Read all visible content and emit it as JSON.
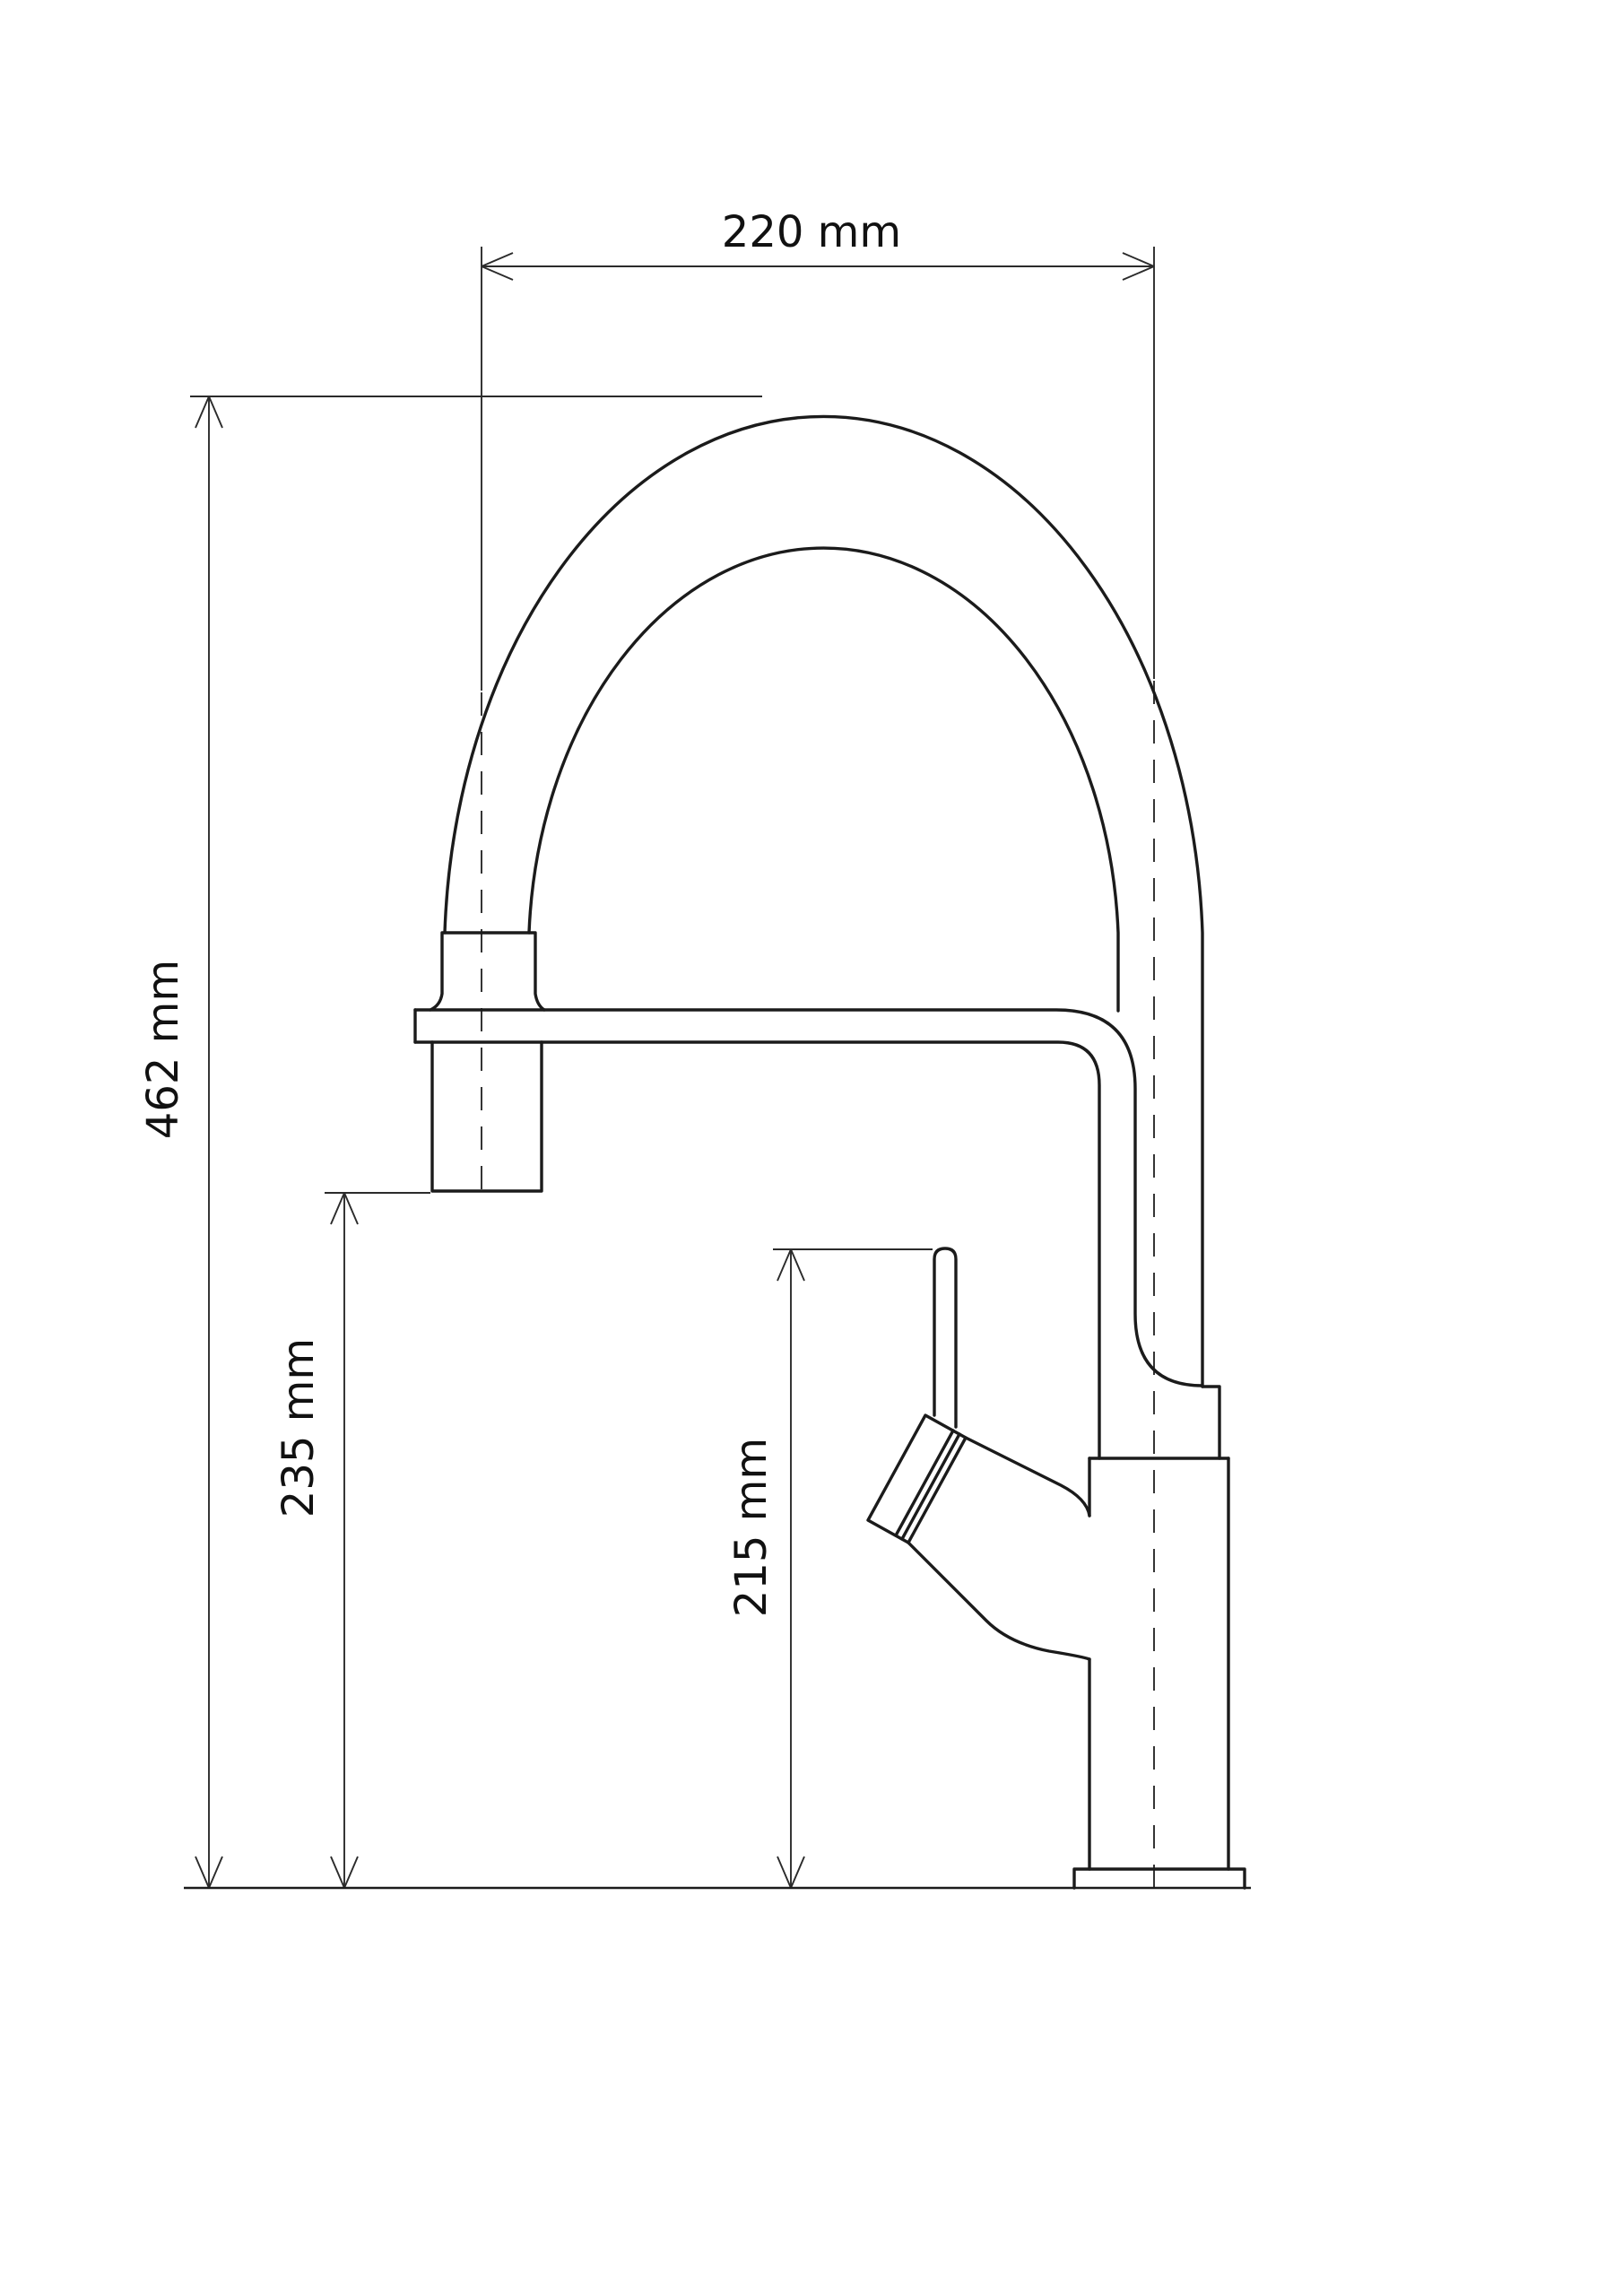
{
  "drawing": {
    "type": "technical-dimension-drawing",
    "subject": "kitchen faucet side view",
    "background_color": "#ffffff",
    "line_color": "#1b1b1b",
    "dimensions": {
      "width_top": {
        "label": "220 mm",
        "value": 220,
        "unit": "mm",
        "orientation": "horizontal"
      },
      "total_height": {
        "label": "462 mm",
        "value": 462,
        "unit": "mm",
        "orientation": "vertical"
      },
      "spout_outlet_height": {
        "label": "235 mm",
        "value": 235,
        "unit": "mm",
        "orientation": "vertical"
      },
      "handle_height": {
        "label": "215 mm",
        "value": 215,
        "unit": "mm",
        "orientation": "vertical"
      }
    }
  }
}
